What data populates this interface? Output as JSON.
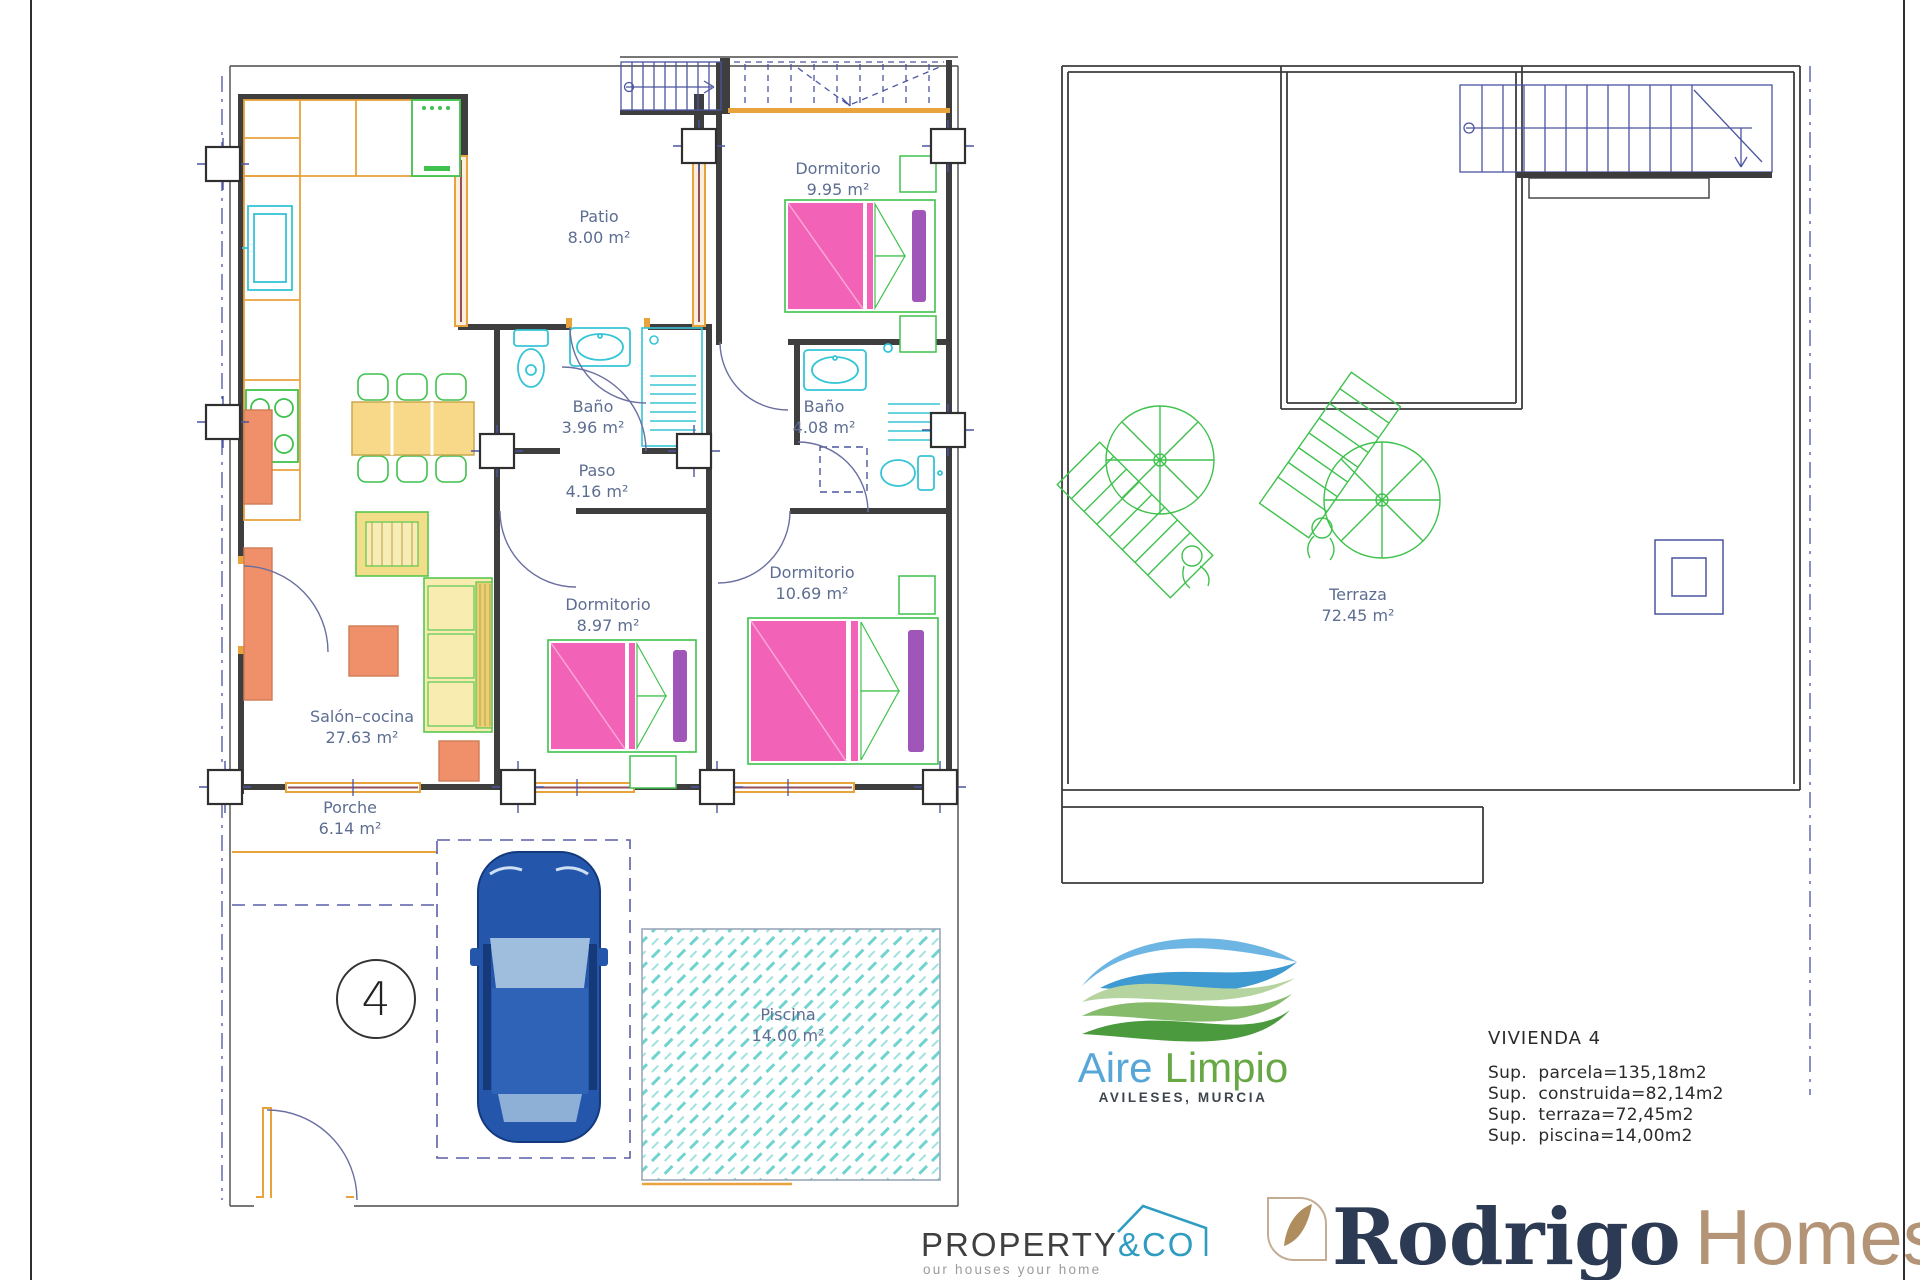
{
  "ground_floor": {
    "rooms": [
      {
        "name": "Patio",
        "area": "8.00 m²"
      },
      {
        "name": "Dormitorio",
        "area": "9.95 m²"
      },
      {
        "name": "Baño",
        "area": "3.96 m²"
      },
      {
        "name": "Baño",
        "area": "4.08 m²"
      },
      {
        "name": "Paso",
        "area": "4.16 m²"
      },
      {
        "name": "Dormitorio",
        "area": "10.69 m²"
      },
      {
        "name": "Dormitorio",
        "area": "8.97 m²"
      },
      {
        "name": "Salón–cocina",
        "area": "27.63 m²"
      },
      {
        "name": "Porche",
        "area": "6.14 m²"
      },
      {
        "name": "Piscina",
        "area": "14.00 m²"
      }
    ],
    "plot_number": "4"
  },
  "roof_plan": {
    "terrace": {
      "name": "Terraza",
      "area": "72.45 m²"
    }
  },
  "info_panel": {
    "title": "VIVIENDA  4",
    "lines": [
      "Sup.  parcela=135,18m2",
      "Sup.  construida=82,14m2",
      "Sup.  terraza=72,45m2",
      "Sup.  piscina=14,00m2"
    ]
  },
  "brands": {
    "aire_limpio": {
      "word1": "Aire",
      "word2": "Limpio",
      "location": "AVILESES, MURCIA"
    },
    "property_co": {
      "word1": "PROPERTY",
      "word2": "&CO",
      "tagline": "our houses your home"
    },
    "rodrigo_homes": {
      "word1": "Rodrigo",
      "word2": "Homes"
    }
  },
  "colors": {
    "wall": "#3e3e3e",
    "label_text": "#5d6e92",
    "carpentry_orange": "#e8a33d",
    "fixture_cyan": "#35c5d6",
    "furniture_green": "#3fc24d",
    "bed_pink": "#f263b8",
    "pillow_purple": "#a055b8",
    "sofa_yellow": "#f2dd88",
    "table_salmon": "#f0906a",
    "car_blue": "#2456ac",
    "pool_teal": "#6fd4cf",
    "stairs_navy": "#4a55a0",
    "aire_blue": "#56a7d8",
    "aire_green": "#67a845",
    "property_accent": "#2f9cc2",
    "rodrigo_navy": "#2c3a53",
    "rodrigo_tan": "#b39476"
  }
}
